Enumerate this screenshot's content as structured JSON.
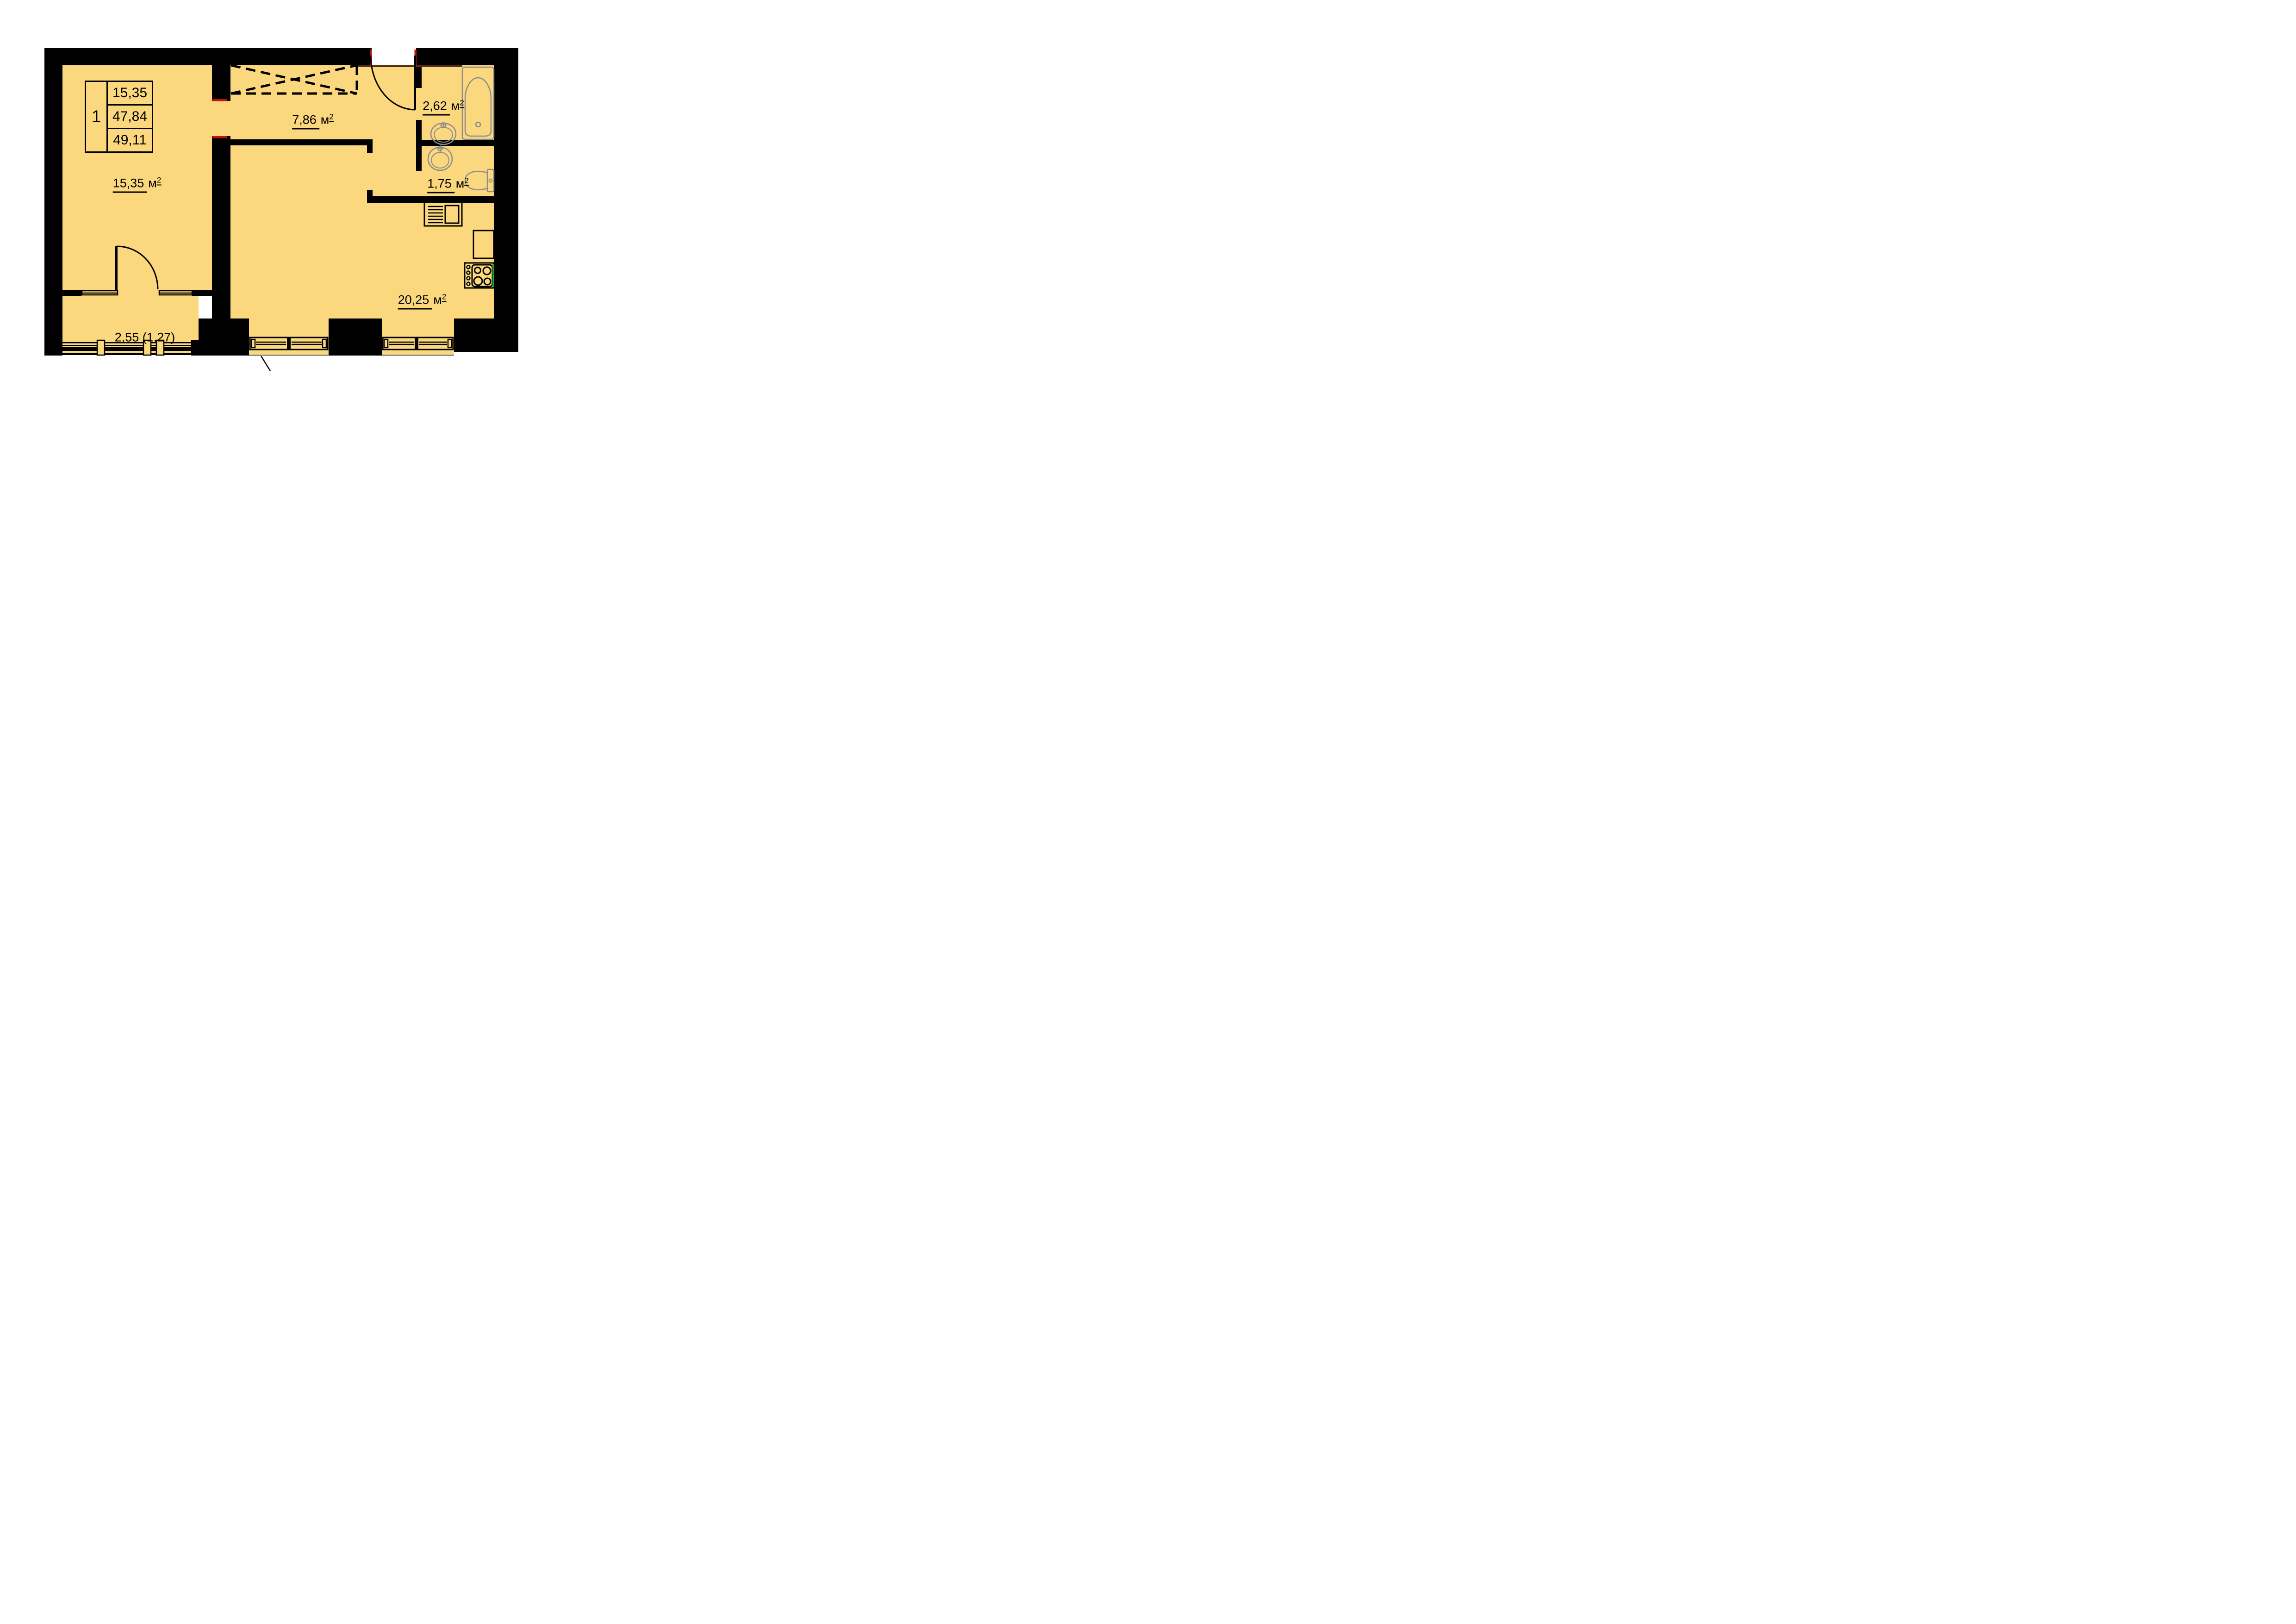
{
  "legend": {
    "unit_number": "1",
    "area_living": "15,35",
    "area_apartment": "47,84",
    "area_total": "49,11"
  },
  "rooms": {
    "living": {
      "num": "15,35",
      "unit": "м",
      "sup": "2"
    },
    "hallway": {
      "num": "7,86",
      "unit": "м",
      "sup": "2"
    },
    "bathroom": {
      "num": "2,62",
      "unit": "м",
      "sup": "2"
    },
    "wc": {
      "num": "1,75",
      "unit": "м",
      "sup": "2"
    },
    "kitchen": {
      "num": "20,25",
      "unit": "м",
      "sup": "2"
    }
  },
  "balcony": {
    "label": "2,55 (1,27)"
  },
  "fixtures": [
    "bathtub",
    "washbasin-bathroom",
    "washbasin-wc",
    "toilet",
    "kitchen-sink",
    "kitchen-counter",
    "cooktop",
    "built-in-wardrobe",
    "entrance-door",
    "balcony-door",
    "window",
    "balcony-glazing"
  ],
  "colors": {
    "floor": "#FBD87D",
    "wall": "#000000",
    "fixture": "#8C8C8C",
    "accent_red": "#C2140B",
    "accent_green": "#21A621",
    "threshold": "#4E3216"
  }
}
